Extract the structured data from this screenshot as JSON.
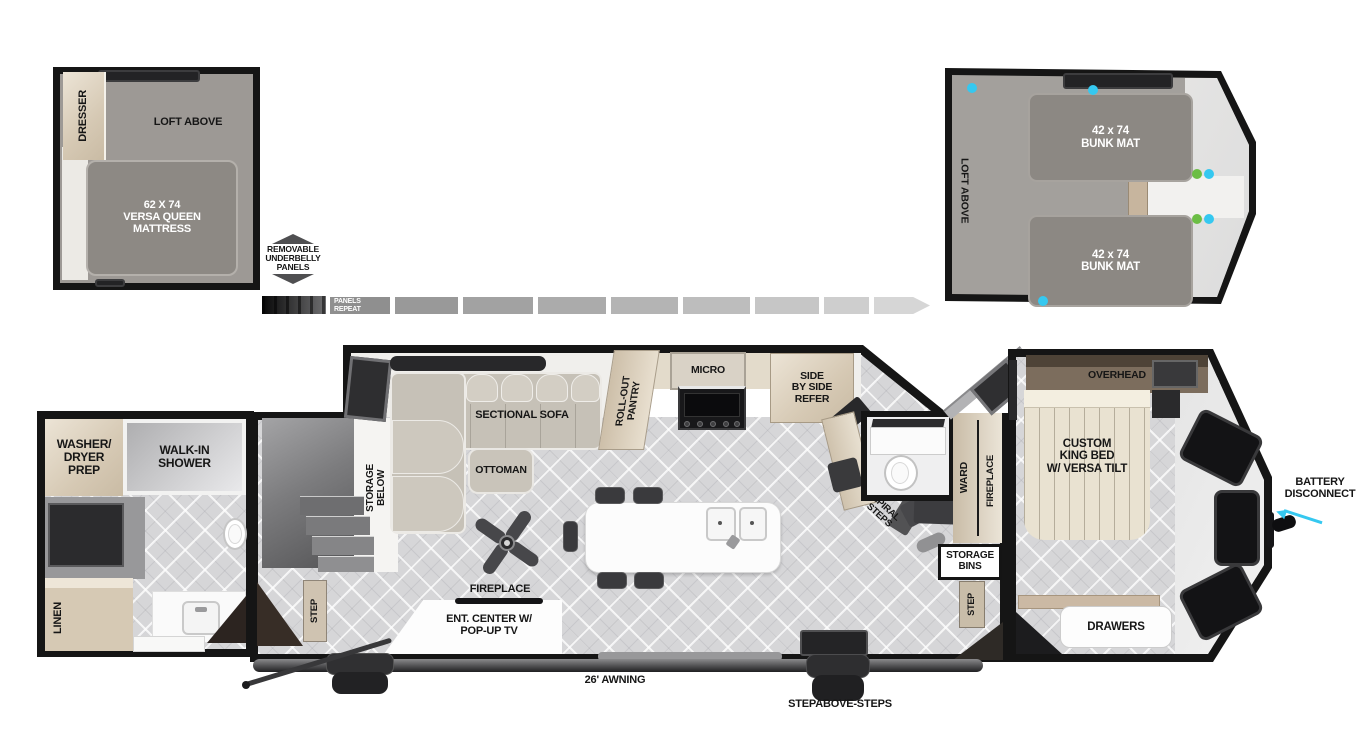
{
  "floorplan": {
    "front_loft": {
      "dresser": "DRESSER",
      "loft_above": "LOFT ABOVE",
      "mattress": "62 X 74\nVERSA QUEEN\nMATTRESS"
    },
    "rear_loft": {
      "loft_above": "LOFT ABOVE",
      "bunk_top": "42 x 74\nBUNK MAT",
      "bunk_bottom": "42 x 74\nBUNK MAT"
    },
    "underbelly": {
      "callout": "REMOVABLE\nUNDERBELLY\nPANELS",
      "panels_repeat": "PANELS\nREPEAT"
    },
    "bath": {
      "washer_dryer": "WASHER/\nDRYER\nPREP",
      "shower": "WALK-IN\nSHOWER",
      "linen": "LINEN"
    },
    "living": {
      "step_left": "STEP",
      "storage_below": "STORAGE\nBELOW",
      "sectional_sofa": "SECTIONAL SOFA",
      "ottoman": "OTTOMAN",
      "fireplace": "FIREPLACE",
      "ent_center": "ENT. CENTER W/\nPOP-UP TV"
    },
    "kitchen": {
      "pantry": "ROLL-OUT\nPANTRY",
      "micro": "MICRO",
      "refer": "SIDE\nBY SIDE\nREFER"
    },
    "mid_section": {
      "spiral_steps": "SPIRAL\nSTEPS",
      "ward": "WARD",
      "fireplace": "FIREPLACE",
      "storage_bins": "STORAGE\nBINS",
      "step_right": "STEP"
    },
    "bedroom": {
      "overhead": "OVERHEAD",
      "bed": "CUSTOM\nKING BED\nW/ VERSA TILT",
      "drawers": "DRAWERS",
      "battery_disconnect": "BATTERY\nDISCONNECT"
    },
    "exterior": {
      "awning": "26' AWNING",
      "steps": "STEPABOVE-STEPS"
    }
  },
  "colors": {
    "wall": "#151515",
    "floor_tile": "#d6d6d8",
    "loft_floor": "#9d9995",
    "cabinet_beige": "#d9cdbb",
    "mattress_gray": "#8d8984",
    "accent_cyan": "#35c8f0",
    "accent_green": "#6cbe45"
  }
}
